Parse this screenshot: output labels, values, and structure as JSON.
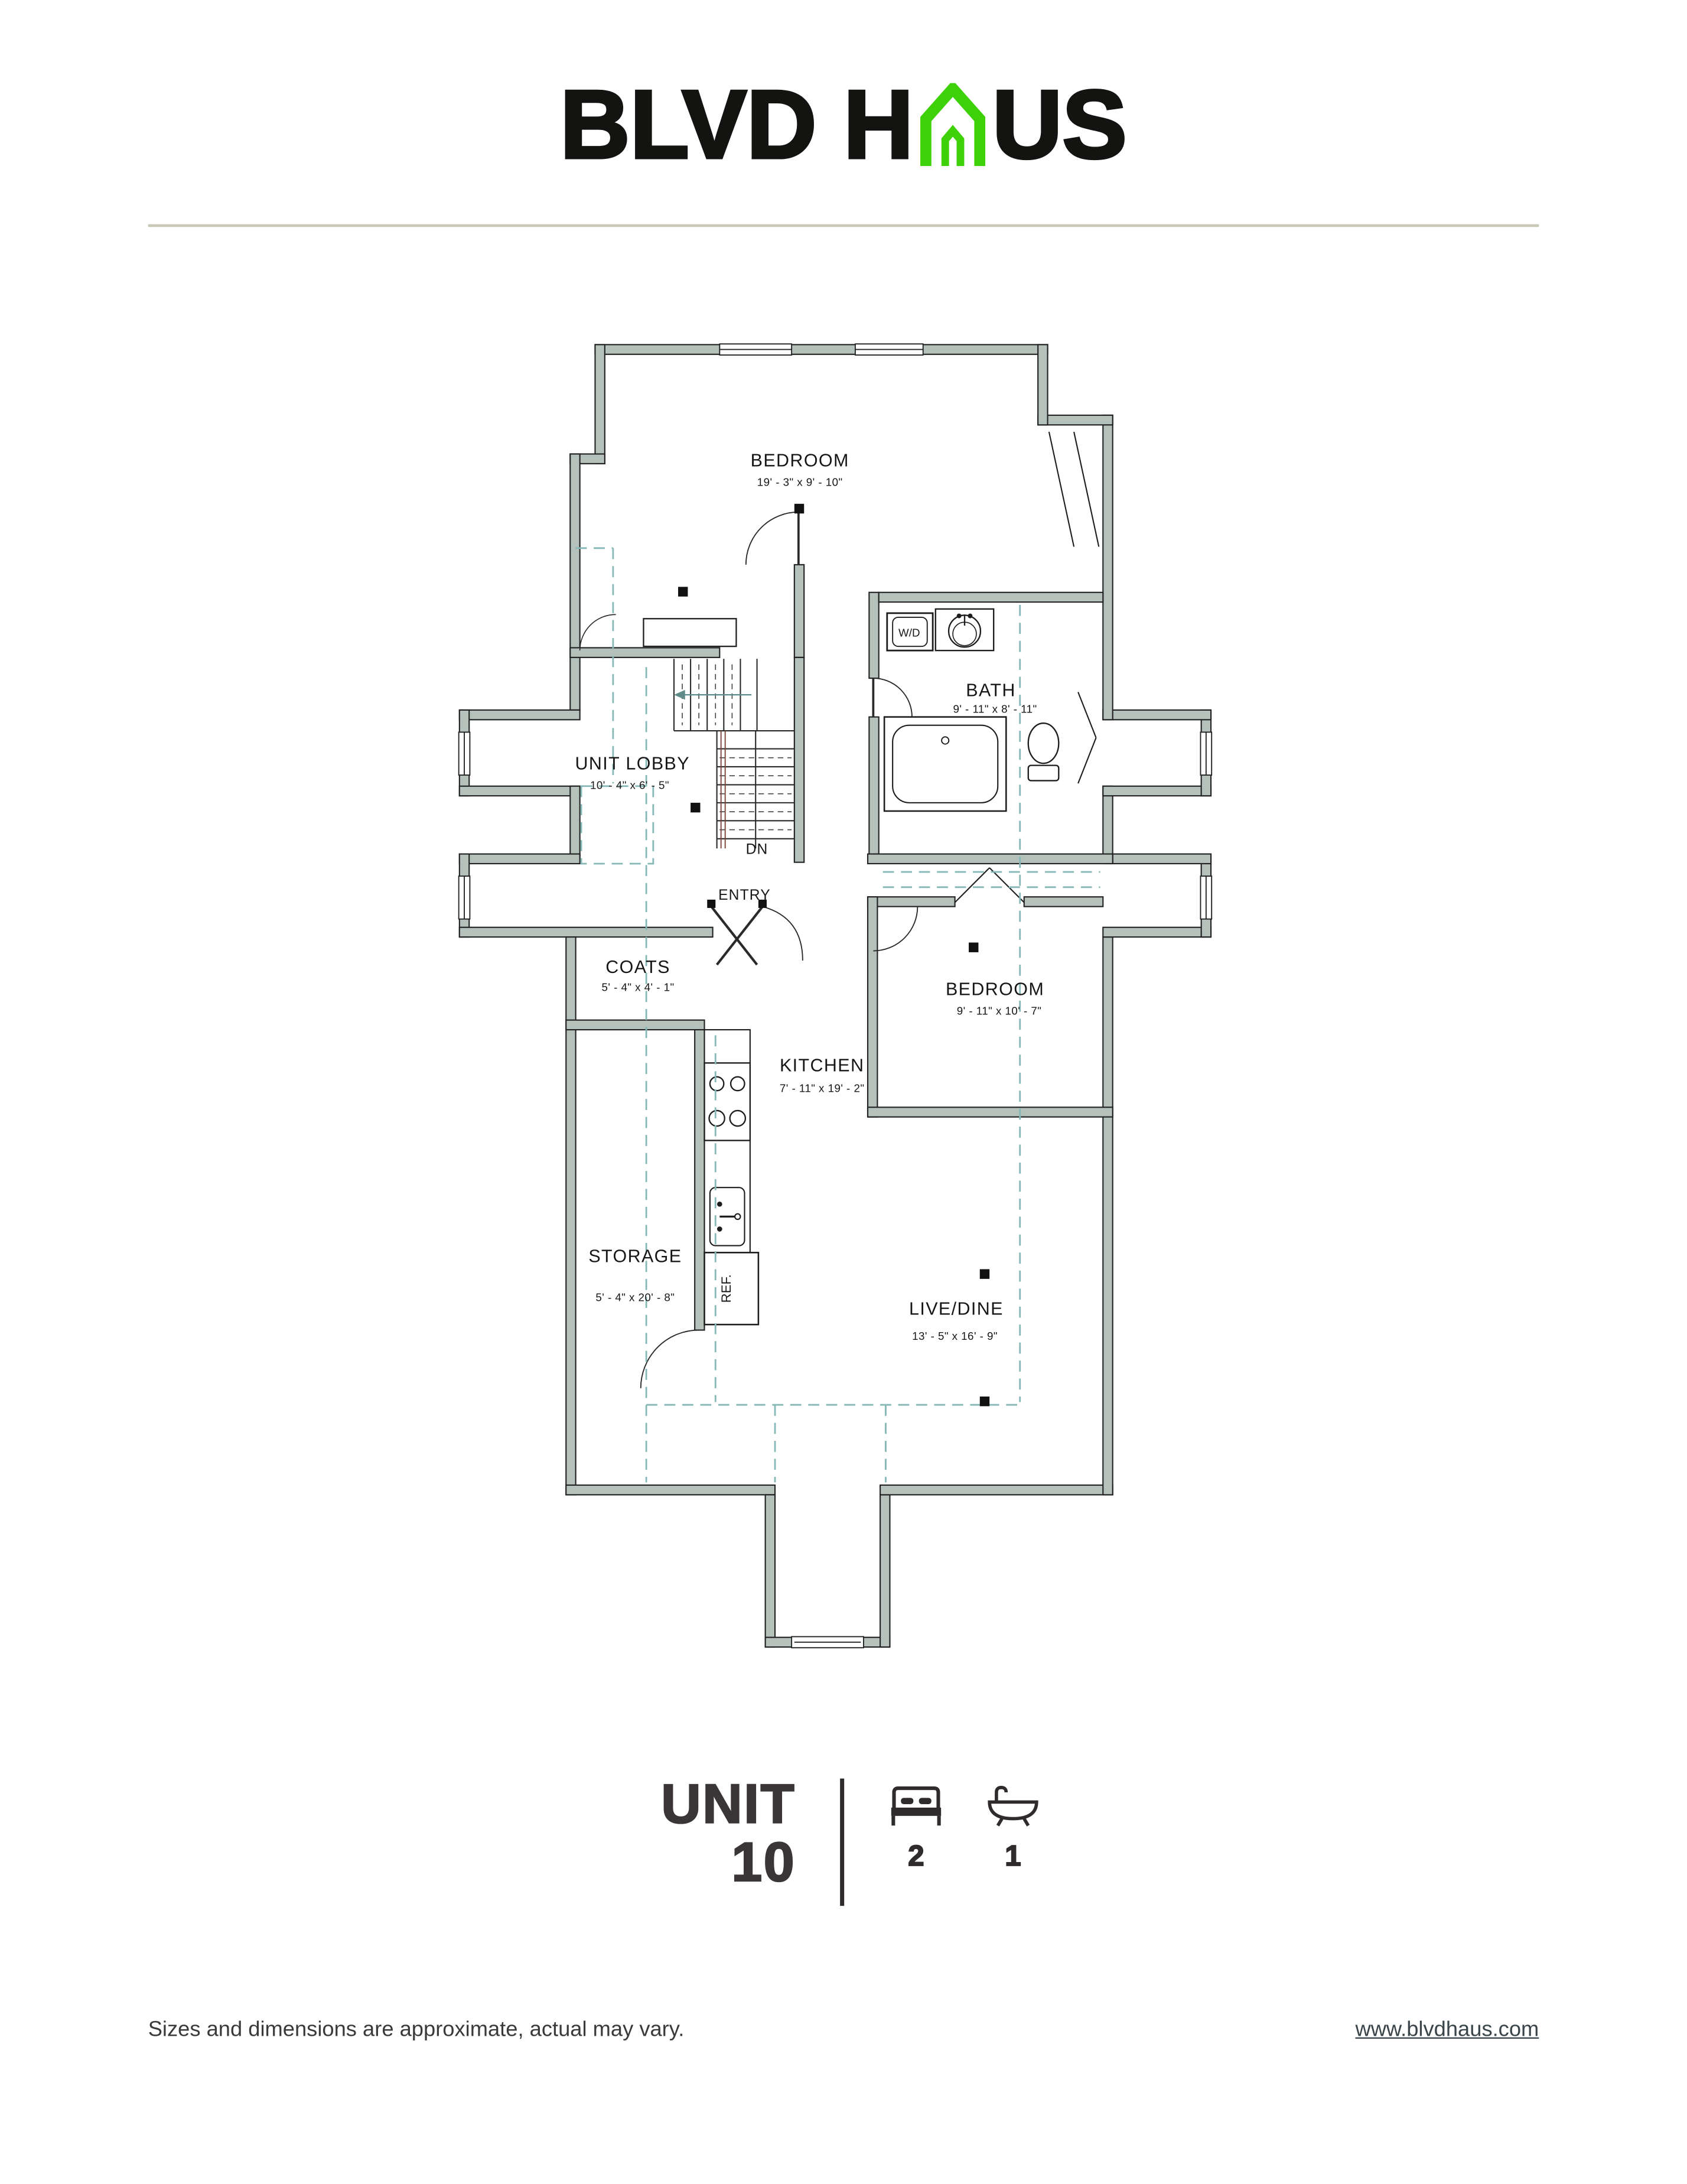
{
  "logo": {
    "text_before": "BLVD H",
    "text_after": "US"
  },
  "brand": {
    "accent_green": "#3ed108",
    "ink": "#131412",
    "rule_color": "#c9c9b6"
  },
  "floorplan": {
    "wall_color": "#b5c1bb",
    "dash_color": "#85b8b6",
    "rooms": [
      {
        "id": "bedroom-1",
        "name": "BEDROOM",
        "dims": "19' - 3\" x 9' - 10\""
      },
      {
        "id": "bath",
        "name": "BATH",
        "dims": "9' - 11\" x 8' - 11\""
      },
      {
        "id": "unit-lobby",
        "name": "UNIT LOBBY",
        "dims": "10' - 4\" x 6' - 5\""
      },
      {
        "id": "coats",
        "name": "COATS",
        "dims": "5' - 4\" x 4' - 1\""
      },
      {
        "id": "bedroom-2",
        "name": "BEDROOM",
        "dims": "9' - 11\" x 10' - 7\""
      },
      {
        "id": "kitchen",
        "name": "KITCHEN",
        "dims": "7' - 11\" x 19' - 2\""
      },
      {
        "id": "storage",
        "name": "STORAGE",
        "dims": "5' - 4\" x 20' - 8\""
      },
      {
        "id": "live-dine",
        "name": "LIVE/DINE",
        "dims": "13' - 5\" x 16' - 9\""
      }
    ],
    "annotations": {
      "down": "DN",
      "entry": "ENTRY",
      "washer_dryer": "W/D",
      "refrigerator": "REF."
    }
  },
  "unit": {
    "label": "UNIT",
    "number": "10",
    "bedrooms": "2",
    "bathrooms": "1"
  },
  "footer": {
    "disclaimer": "Sizes and dimensions are approximate, actual may vary.",
    "website": "www.blvdhaus.com"
  }
}
